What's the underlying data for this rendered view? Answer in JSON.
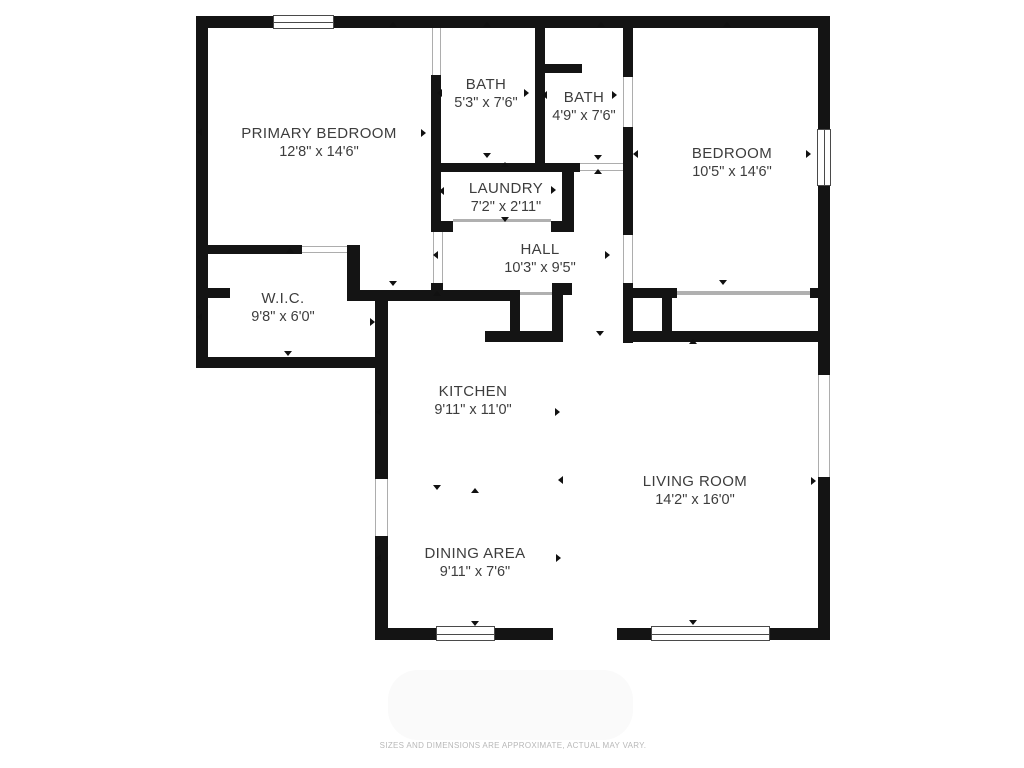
{
  "meta": {
    "disclaimer": "SIZES AND DIMENSIONS ARE APPROXIMATE, ACTUAL MAY VARY."
  },
  "colors": {
    "wall": "#141414",
    "label_text": "#3d3d3d",
    "thin_line": "#adadad",
    "marker": "#111111",
    "disclaimer_text": "#b8b8b8",
    "background": "#ffffff"
  },
  "rooms": [
    {
      "id": "primary-bedroom",
      "name": "PRIMARY BEDROOM",
      "dims": "12'8\" x 14'6\"",
      "cx": 319,
      "cy": 125
    },
    {
      "id": "bath-1",
      "name": "BATH",
      "dims": "5'3\" x 7'6\"",
      "cx": 486,
      "cy": 76
    },
    {
      "id": "bath-2",
      "name": "BATH",
      "dims": "4'9\" x 7'6\"",
      "cx": 584,
      "cy": 89
    },
    {
      "id": "bedroom",
      "name": "BEDROOM",
      "dims": "10'5\" x 14'6\"",
      "cx": 732,
      "cy": 145
    },
    {
      "id": "laundry",
      "name": "LAUNDRY",
      "dims": "7'2\" x 2'11\"",
      "cx": 506,
      "cy": 180
    },
    {
      "id": "hall",
      "name": "HALL",
      "dims": "10'3\" x 9'5\"",
      "cx": 540,
      "cy": 241
    },
    {
      "id": "wic",
      "name": "W.I.C.",
      "dims": "9'8\" x 6'0\"",
      "cx": 283,
      "cy": 290
    },
    {
      "id": "kitchen",
      "name": "KITCHEN",
      "dims": "9'11\" x 11'0\"",
      "cx": 473,
      "cy": 383
    },
    {
      "id": "living-room",
      "name": "LIVING ROOM",
      "dims": "14'2\" x 16'0\"",
      "cx": 695,
      "cy": 473
    },
    {
      "id": "dining-area",
      "name": "DINING AREA",
      "dims": "9'11\" x 7'6\"",
      "cx": 475,
      "cy": 545
    }
  ],
  "walls": [
    [
      196,
      16,
      79,
      12
    ],
    [
      334,
      16,
      496,
      12
    ],
    [
      196,
      16,
      12,
      352
    ],
    [
      196,
      357,
      192,
      11
    ],
    [
      375,
      299,
      13,
      180
    ],
    [
      375,
      536,
      13,
      104
    ],
    [
      375,
      628,
      178,
      12
    ],
    [
      617,
      628,
      213,
      12
    ],
    [
      818,
      16,
      12,
      114
    ],
    [
      818,
      185,
      12,
      190
    ],
    [
      818,
      477,
      12,
      163
    ],
    [
      431,
      75,
      10,
      157
    ],
    [
      535,
      28,
      10,
      144
    ],
    [
      545,
      64,
      37,
      9
    ],
    [
      431,
      163,
      149,
      9
    ],
    [
      562,
      165,
      12,
      67
    ],
    [
      551,
      221,
      11,
      11
    ],
    [
      441,
      221,
      12,
      11
    ],
    [
      431,
      283,
      12,
      10
    ],
    [
      196,
      245,
      106,
      9
    ],
    [
      347,
      245,
      13,
      53
    ],
    [
      196,
      288,
      34,
      10
    ],
    [
      347,
      290,
      173,
      11
    ],
    [
      510,
      290,
      10,
      50
    ],
    [
      485,
      331,
      78,
      11
    ],
    [
      552,
      290,
      11,
      50
    ],
    [
      552,
      283,
      20,
      12
    ],
    [
      623,
      28,
      10,
      49
    ],
    [
      623,
      127,
      10,
      108
    ],
    [
      623,
      283,
      10,
      60
    ],
    [
      625,
      331,
      195,
      11
    ],
    [
      633,
      288,
      44,
      10
    ],
    [
      810,
      288,
      8,
      10
    ],
    [
      662,
      298,
      10,
      35
    ]
  ],
  "windows": [
    {
      "x": 273,
      "y": 15,
      "w": 61,
      "h": 14,
      "o": "h",
      "name": "window-top-primary-bedroom"
    },
    {
      "x": 817,
      "y": 129,
      "w": 14,
      "h": 57,
      "o": "v",
      "name": "window-bedroom-east"
    },
    {
      "x": 436,
      "y": 626,
      "w": 59,
      "h": 15,
      "o": "h",
      "name": "window-dining-south"
    },
    {
      "x": 651,
      "y": 626,
      "w": 119,
      "h": 15,
      "o": "h",
      "name": "window-living-south"
    }
  ],
  "openings": [
    {
      "x": 432,
      "y": 28,
      "w": 9,
      "h": 47,
      "o": "v",
      "name": "door-primary-to-bath"
    },
    {
      "x": 433,
      "y": 232,
      "w": 10,
      "h": 51,
      "o": "v",
      "name": "door-primary-to-hall"
    },
    {
      "x": 580,
      "y": 163,
      "w": 43,
      "h": 8,
      "o": "h",
      "name": "door-bath2-to-hall"
    },
    {
      "x": 453,
      "y": 219,
      "w": 98,
      "h": 3,
      "o": "line",
      "name": "door-laundry"
    },
    {
      "x": 302,
      "y": 246,
      "w": 45,
      "h": 7,
      "o": "h",
      "name": "door-wic"
    },
    {
      "x": 623,
      "y": 77,
      "w": 10,
      "h": 50,
      "o": "v",
      "name": "door-bath2-to-bedroom"
    },
    {
      "x": 623,
      "y": 235,
      "w": 10,
      "h": 48,
      "o": "v",
      "name": "door-bedroom"
    },
    {
      "x": 677,
      "y": 291,
      "w": 133,
      "h": 4,
      "o": "line",
      "name": "closet-slider-bedroom"
    },
    {
      "x": 818,
      "y": 375,
      "w": 12,
      "h": 102,
      "o": "v",
      "name": "patio-slider-living"
    },
    {
      "x": 375,
      "y": 479,
      "w": 13,
      "h": 57,
      "o": "v",
      "name": "opening-kitchen-west"
    },
    {
      "x": 520,
      "y": 292,
      "w": 32,
      "h": 3,
      "o": "line",
      "name": "closet-front-hall"
    }
  ],
  "markers": [
    {
      "x": 393,
      "y": 26,
      "d": "up"
    },
    {
      "x": 487,
      "y": 26,
      "d": "up"
    },
    {
      "x": 601,
      "y": 26,
      "d": "up"
    },
    {
      "x": 727,
      "y": 26,
      "d": "up"
    },
    {
      "x": 290,
      "y": 252,
      "d": "up"
    },
    {
      "x": 437,
      "y": 295,
      "d": "up"
    },
    {
      "x": 475,
      "y": 492,
      "d": "up"
    },
    {
      "x": 693,
      "y": 343,
      "d": "up"
    },
    {
      "x": 505,
      "y": 166,
      "d": "up"
    },
    {
      "x": 598,
      "y": 173,
      "d": "up"
    },
    {
      "x": 487,
      "y": 157,
      "d": "down"
    },
    {
      "x": 598,
      "y": 159,
      "d": "down"
    },
    {
      "x": 505,
      "y": 221,
      "d": "down"
    },
    {
      "x": 393,
      "y": 285,
      "d": "down"
    },
    {
      "x": 288,
      "y": 355,
      "d": "down"
    },
    {
      "x": 437,
      "y": 489,
      "d": "down"
    },
    {
      "x": 475,
      "y": 625,
      "d": "down"
    },
    {
      "x": 693,
      "y": 624,
      "d": "down"
    },
    {
      "x": 723,
      "y": 284,
      "d": "down"
    },
    {
      "x": 600,
      "y": 335,
      "d": "down"
    },
    {
      "x": 201,
      "y": 132,
      "d": "left"
    },
    {
      "x": 441,
      "y": 93,
      "d": "left"
    },
    {
      "x": 546,
      "y": 95,
      "d": "left"
    },
    {
      "x": 443,
      "y": 191,
      "d": "left"
    },
    {
      "x": 201,
      "y": 317,
      "d": "left"
    },
    {
      "x": 380,
      "y": 412,
      "d": "left"
    },
    {
      "x": 380,
      "y": 558,
      "d": "left"
    },
    {
      "x": 562,
      "y": 480,
      "d": "left"
    },
    {
      "x": 637,
      "y": 154,
      "d": "left"
    },
    {
      "x": 437,
      "y": 255,
      "d": "left"
    },
    {
      "x": 425,
      "y": 133,
      "d": "right"
    },
    {
      "x": 528,
      "y": 93,
      "d": "right"
    },
    {
      "x": 616,
      "y": 95,
      "d": "right"
    },
    {
      "x": 555,
      "y": 190,
      "d": "right"
    },
    {
      "x": 374,
      "y": 322,
      "d": "right"
    },
    {
      "x": 559,
      "y": 412,
      "d": "right"
    },
    {
      "x": 560,
      "y": 558,
      "d": "right"
    },
    {
      "x": 815,
      "y": 481,
      "d": "right"
    },
    {
      "x": 810,
      "y": 154,
      "d": "right"
    },
    {
      "x": 609,
      "y": 255,
      "d": "right"
    }
  ]
}
